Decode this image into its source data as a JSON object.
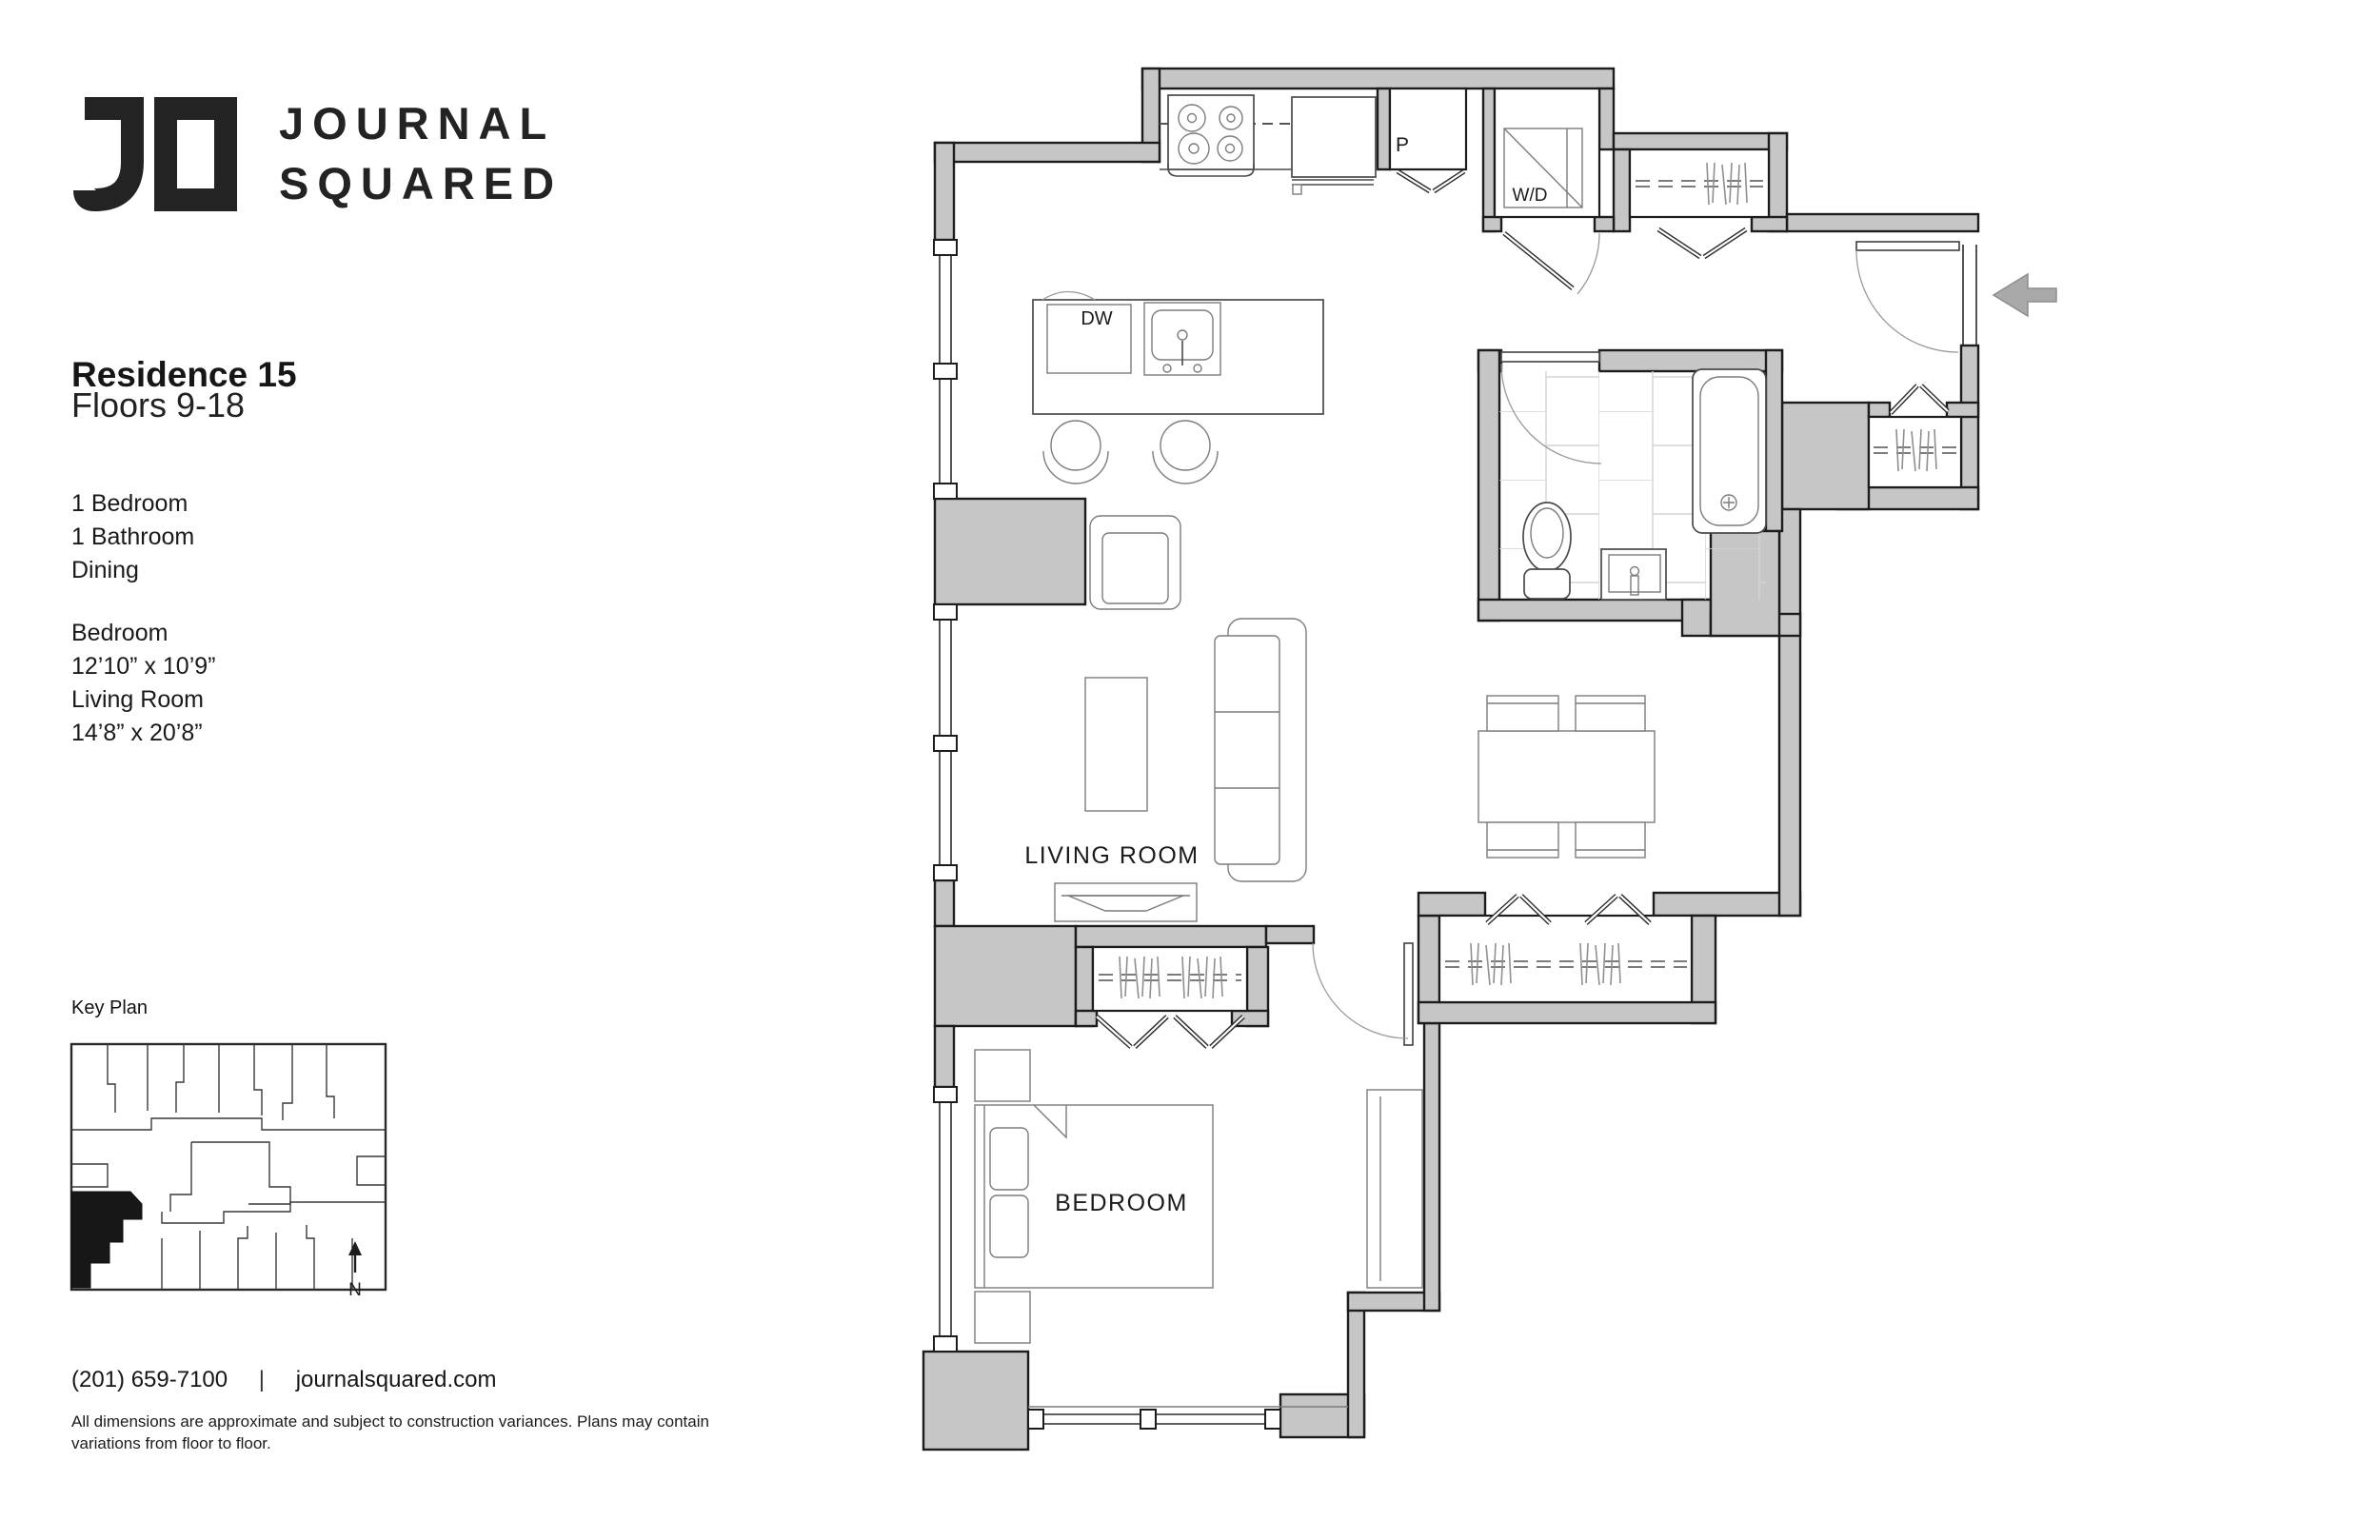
{
  "brand": {
    "mark": "jo-monogram",
    "line1": "JOURNAL",
    "line2": "SQUARED"
  },
  "residence": {
    "title": "Residence 15",
    "floors": "Floors 9-18",
    "features": [
      "1 Bedroom",
      "1 Bathroom",
      "Dining"
    ],
    "rooms": [
      {
        "name": "Bedroom",
        "size": "12’10” x 10’9”"
      },
      {
        "name": "Living Room",
        "size": "14’8” x 20’8”"
      }
    ]
  },
  "key_plan": {
    "label": "Key Plan",
    "north": "N"
  },
  "contact": {
    "phone": "(201) 659-7100",
    "divider": "|",
    "website": "journalsquared.com"
  },
  "disclaimer": {
    "line1": "All dimensions are approximate and subject to construction variances. Plans may contain",
    "line2": "variations from floor to floor."
  },
  "plan": {
    "living_room": "LIVING ROOM",
    "bedroom": "BEDROOM",
    "pantry": "P",
    "washer_dryer": "W/D",
    "dishwasher": "DW",
    "colors": {
      "wall_fill": "#c6c6c6",
      "wall_line": "#1c1c1c",
      "fixture_line": "#4a4a4a",
      "furniture_line": "#7c7c7c",
      "tile_line": "#d4d4d4",
      "entry_arrow": "#a9a9a9"
    }
  }
}
